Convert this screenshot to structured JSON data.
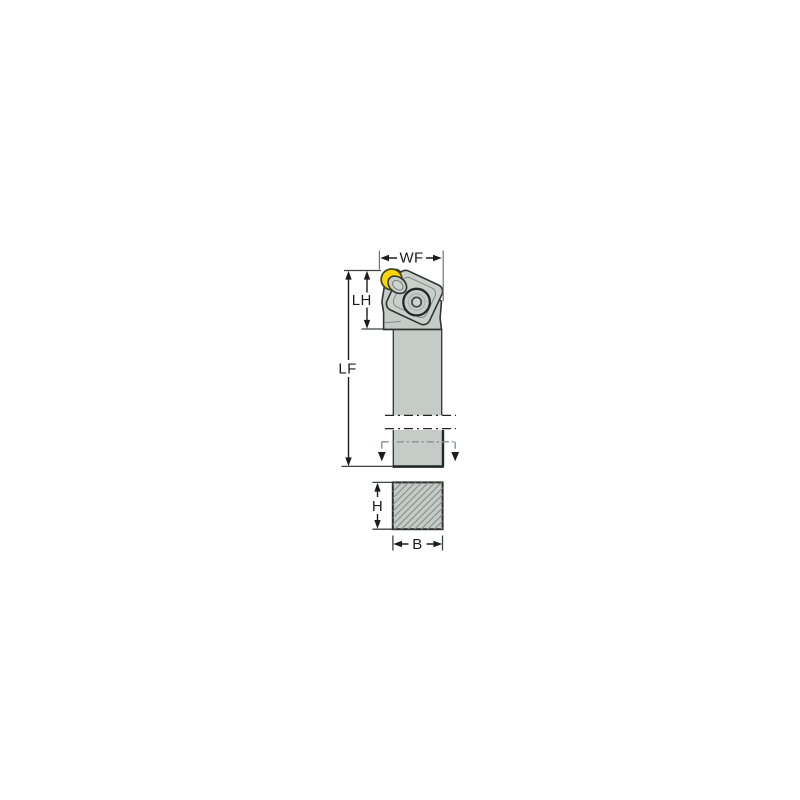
{
  "diagram": {
    "title": "lathe-toolholder-dimension-drawing",
    "labels": {
      "wf": "WF",
      "lh": "LH",
      "lf": "LF",
      "h": "H",
      "b": "B"
    },
    "colors": {
      "background": "#ffffff",
      "body_fill": "#c5cbc7",
      "clamp_fill": "#c9cfca",
      "screw_hole_fill": "#ced4d0",
      "body_outline": "#2f3433",
      "insert_fill": "#fdd500",
      "insert_outline": "#45431a",
      "dimension_line": "#1c1c1c",
      "witness_line": "#6e7476",
      "hatch_line": "#878d89",
      "break_line": "#232323",
      "dashdot_grey": "#8a9093"
    }
  }
}
